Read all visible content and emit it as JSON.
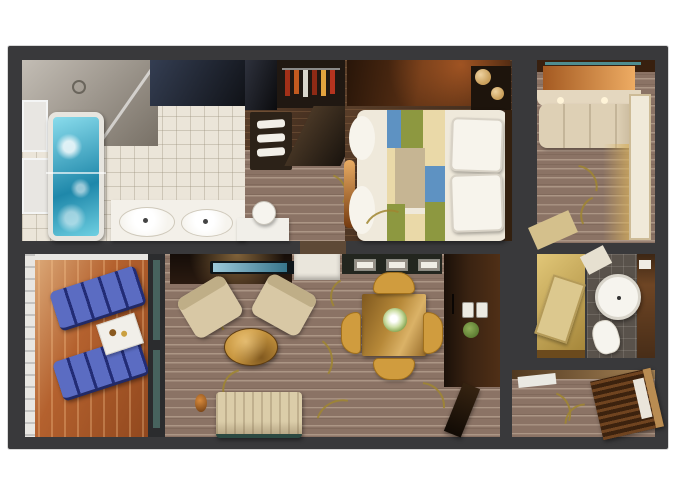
{
  "scene": {
    "type": "3d-rendered-floor-plan",
    "view": "top-down cutaway of a two-bedroom suite with private balcony",
    "rooms": [
      {
        "id": "master-bathroom",
        "contents": [
          "shower",
          "whirlpool-bathtub",
          "double-sink-vanity",
          "mirror-cabinet",
          "window-ledges"
        ]
      },
      {
        "id": "dressing-area",
        "contents": [
          "wardrobe-with-clothes",
          "dark-cabinet",
          "towel-shelf",
          "vanity-desk",
          "stool"
        ]
      },
      {
        "id": "master-bedroom",
        "contents": [
          "queen-bed",
          "patchwork-runner",
          "two-pillows",
          "nightstand",
          "round-lamps",
          "console",
          "floor-lamp"
        ]
      },
      {
        "id": "second-bedroom",
        "contents": [
          "sofa-bed",
          "cream-wall-panel",
          "wall-lights",
          "entry-wedge"
        ]
      },
      {
        "id": "luggage-closet",
        "contents": [
          "luggage-bench"
        ]
      },
      {
        "id": "second-bathroom",
        "contents": [
          "round-shower-basin",
          "toilet",
          "wood-counter",
          "tissue-box"
        ]
      },
      {
        "id": "balcony",
        "contents": [
          "lounge-chair",
          "lounge-chair",
          "side-table",
          "white-railing",
          "glass-door"
        ]
      },
      {
        "id": "living-room",
        "contents": [
          "tv-cabinet",
          "tv-screen",
          "white-counter",
          "armchair",
          "armchair",
          "oval-coffee-table",
          "sofa",
          "plant"
        ]
      },
      {
        "id": "dining-area",
        "contents": [
          "square-dining-table",
          "four-gold-chairs",
          "flower-centerpiece",
          "serving-counter",
          "three-trays"
        ]
      },
      {
        "id": "entry",
        "contents": [
          "tall-dark-cabinet",
          "light-switches",
          "wall-plant",
          "open-door"
        ]
      },
      {
        "id": "hallway",
        "contents": [
          "white-mat",
          "angled-ribbed-cabinet"
        ]
      }
    ]
  },
  "colors": {
    "background": "#ffffff",
    "wall": "#39393b",
    "carpet": "#8b7365",
    "woodDark": "#4a3222",
    "deck": "#b4612e",
    "tileFloor": "#ebe5d9",
    "showerGray": "#a39a8d",
    "mirrorDark": "#20242e",
    "tubWater": "#45b9d6",
    "tubRim": "#e7e5df",
    "porcelain": "#f6f4ee",
    "vanityTop": "#f3f0e9",
    "cabinetNavy": "#15161b",
    "wardrobeDark": "#201812",
    "towelWhite": "#f2efe8",
    "partitionDark": "#2c2218",
    "lounger": "#3b4aa5",
    "railWhite": "#e8e6e2",
    "tableWhite": "#f1efe9",
    "glassTeal": "rgba(95,145,135,0.55)",
    "duvet": "#efe9db",
    "pillow": "#f7f4ec",
    "runnerBlue": "#5e92c2",
    "runnerOlive": "#8d9840",
    "runnerCream": "#ead9a8",
    "runnerTan": "#c6b593",
    "headboard": "#33200f",
    "consoleWood": "#5a3014",
    "nightstand": "#1d140c",
    "lampGold": "#caa05c",
    "floorLampOrange": "#c97427",
    "tvCabinet": "#2a1a10",
    "tvScreen": "#4a9cba",
    "counterWhite": "#eae6dc",
    "counterDark": "#23261f",
    "tray": "#f0ede5",
    "armchairCream": "#d8c8a5",
    "armchairBack": "#bfae87",
    "coffeeTable": "#c8963f",
    "sofaCream": "#dbcda9",
    "sofaBase": "#2c4a42",
    "diningWood": "#b68838",
    "chairGold": "#d09c3e",
    "flowerGreen": "#7fa04a",
    "entryCabinet": "#3a2312",
    "switchWhite": "#eceae2",
    "plantGreen": "#5d7d33",
    "doorDark": "#1d1208",
    "hallWood": "#7a5630",
    "matWhite": "#eae9e2",
    "hallCabinet": "#3c220e",
    "hallCabinetRail": "#b98c52",
    "room2Sofa": "#ded0b5",
    "creamBand": "#e4d7bf",
    "creamPanel": "#f0e9d9",
    "warmGlow": "#d98a3e",
    "tealStrip": "#4e8d90",
    "topWood": "#38200f",
    "tanCloset": "#c9a94f",
    "luggageTan": "#dcc88e",
    "bath2Floor": "#59524b",
    "counterWood": "#6e4524",
    "entryWedge": "#d4c08c",
    "vineGold": "#a08631",
    "midOpening": "#5e4936"
  },
  "cssVars": {
    "--vine": "#a08631"
  }
}
